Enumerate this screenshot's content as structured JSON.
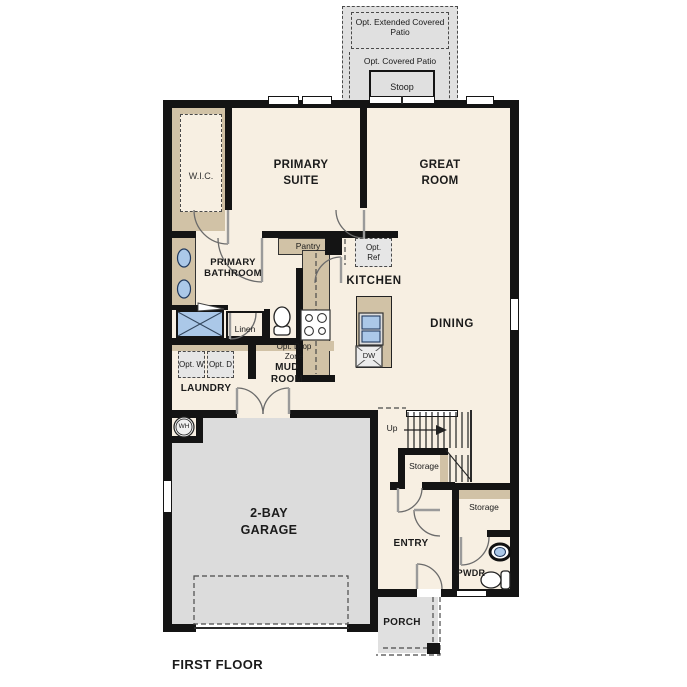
{
  "title": {
    "first_floor": "FIRST FLOOR"
  },
  "colors": {
    "wall": "#141414",
    "floor_cream": "#f7efe2",
    "cabinet_tan": "#d1c2a6",
    "concrete_gray": "#e0e0e0",
    "garage_gray": "#dcdcdc",
    "fixture_blue": "#abc8e8",
    "option_fill": "#e6e6e6"
  },
  "outdoor": {
    "opt_extended_patio": "Opt. Extended Covered Patio",
    "opt_covered_patio": "Opt. Covered Patio",
    "stoop": "Stoop",
    "porch": "PORCH"
  },
  "rooms": {
    "primary_suite": "PRIMARY SUITE",
    "great_room": "GREAT ROOM",
    "wic": "W.I.C.",
    "primary_bathroom": "PRIMARY BATHROOM",
    "kitchen": "KITCHEN",
    "dining": "DINING",
    "laundry": "LAUNDRY",
    "mud_room": "MUD ROOM",
    "garage": "2-BAY GARAGE",
    "entry": "ENTRY",
    "pwdr": "PWDR"
  },
  "closets": {
    "pantry": "Pantry",
    "linen": "Linen",
    "storage_under_stairs": "Storage",
    "storage_entry": "Storage"
  },
  "options": {
    "opt_ref": "Opt. Ref",
    "opt_washer": "Opt. W",
    "opt_dryer": "Opt. D",
    "opt_drop_zone": "Opt. Drop Zone"
  },
  "annotations": {
    "stairs_up": "Up",
    "dishwasher": "DW",
    "water_heater": "WH"
  }
}
